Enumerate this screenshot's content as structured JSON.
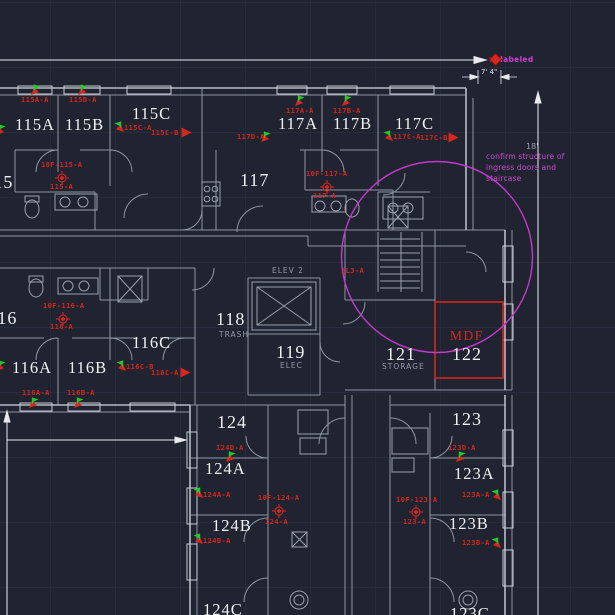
{
  "annotations": {
    "unlabeled": "unlabeled",
    "note": "confirm structure of\ningress doors and\nstaircase",
    "dim_width": "7' 4\"",
    "dim_height": "18'",
    "mdf": "MDF"
  },
  "rooms": [
    {
      "id": "115",
      "label": "115",
      "x": -16,
      "y": 173
    },
    {
      "id": "115A",
      "label": "115A",
      "x": 15,
      "y": 117
    },
    {
      "id": "115B",
      "label": "115B",
      "x": 65,
      "y": 117
    },
    {
      "id": "115C",
      "label": "115C",
      "x": 132,
      "y": 106
    },
    {
      "id": "117",
      "label": "117",
      "x": 240,
      "y": 171
    },
    {
      "id": "117A",
      "label": "117A",
      "x": 278,
      "y": 116
    },
    {
      "id": "117B",
      "label": "117B",
      "x": 333,
      "y": 116
    },
    {
      "id": "117C",
      "label": "117C",
      "x": 395,
      "y": 116
    },
    {
      "id": "116",
      "label": "116",
      "x": -12,
      "y": 309
    },
    {
      "id": "116A",
      "label": "116A",
      "x": 12,
      "y": 360
    },
    {
      "id": "116B",
      "label": "116B",
      "x": 68,
      "y": 360
    },
    {
      "id": "116C",
      "label": "116C",
      "x": 132,
      "y": 335
    },
    {
      "id": "118",
      "label": "118",
      "x": 216,
      "y": 310
    },
    {
      "id": "119",
      "label": "119",
      "x": 276,
      "y": 343
    },
    {
      "id": "121",
      "label": "121",
      "x": 386,
      "y": 345
    },
    {
      "id": "122",
      "label": "122",
      "x": 452,
      "y": 345
    },
    {
      "id": "123",
      "label": "123",
      "x": 452,
      "y": 410
    },
    {
      "id": "123A",
      "label": "123A",
      "x": 454,
      "y": 466
    },
    {
      "id": "123B",
      "label": "123B",
      "x": 449,
      "y": 516
    },
    {
      "id": "124",
      "label": "124",
      "x": 217,
      "y": 413
    },
    {
      "id": "124A",
      "label": "124A",
      "x": 205,
      "y": 461
    },
    {
      "id": "124B",
      "label": "124B",
      "x": 212,
      "y": 518
    },
    {
      "id": "124C",
      "label": "124C",
      "x": 203,
      "y": 602
    },
    {
      "id": "123C",
      "label": "123C",
      "x": 450,
      "y": 606
    }
  ],
  "areas": [
    {
      "id": "elev-2",
      "label": "ELEV 2",
      "x": 272,
      "y": 267
    },
    {
      "id": "trash",
      "label": "TRASH",
      "x": 219,
      "y": 331
    },
    {
      "id": "elec",
      "label": "ELEC",
      "x": 280,
      "y": 362
    },
    {
      "id": "storage",
      "label": "STORAGE",
      "x": 382,
      "y": 363
    }
  ],
  "devices": [
    {
      "id": "115A-A",
      "text": "115A-A",
      "x": 21,
      "y": 97,
      "icon": "horn-strobe",
      "ix": 31,
      "iy": 84
    },
    {
      "id": "115B-A",
      "text": "115B-A",
      "x": 69,
      "y": 97,
      "icon": "horn-strobe",
      "ix": 78,
      "iy": 84
    },
    {
      "id": "115C-A",
      "text": "115C-A",
      "x": 124,
      "y": 125,
      "icon": "horn-strobe",
      "ix": 113,
      "iy": 121,
      "flip": true
    },
    {
      "id": "115C-B",
      "text": "115C-B",
      "x": 151,
      "y": 130,
      "icon": "arrow-right",
      "ix": 181,
      "iy": 127
    },
    {
      "id": "10F-115-A",
      "text": "10F-115-A",
      "x": 41,
      "y": 162,
      "icon": "smoke-detector",
      "ix": 55,
      "iy": 171
    },
    {
      "id": "115-A",
      "text": "115-A",
      "x": 50,
      "y": 184
    },
    {
      "id": "117D-A",
      "text": "117D-A",
      "x": 237,
      "y": 134,
      "icon": "horn-strobe",
      "ix": 261,
      "iy": 131
    },
    {
      "id": "117A-A",
      "text": "117A-A",
      "x": 286,
      "y": 108,
      "icon": "horn-strobe",
      "ix": 295,
      "iy": 95
    },
    {
      "id": "117B-A",
      "text": "117B-A",
      "x": 333,
      "y": 108,
      "icon": "horn-strobe",
      "ix": 342,
      "iy": 95
    },
    {
      "id": "117C-A",
      "text": "117C-A",
      "x": 393,
      "y": 134,
      "icon": "horn-strobe",
      "ix": 382,
      "iy": 130,
      "flip": true
    },
    {
      "id": "117C-B",
      "text": "117C-B",
      "x": 420,
      "y": 135,
      "icon": "arrow-right",
      "ix": 448,
      "iy": 132
    },
    {
      "id": "10F-117-A",
      "text": "10F-117-A",
      "x": 306,
      "y": 171,
      "icon": "smoke-detector",
      "ix": 320,
      "iy": 180
    },
    {
      "id": "117-A",
      "text": "117-A",
      "x": 313,
      "y": 193
    },
    {
      "id": "1L3-A",
      "text": "1L3-A",
      "x": 341,
      "y": 268
    },
    {
      "id": "10F-116-A",
      "text": "10F-116-A",
      "x": 43,
      "y": 303,
      "icon": "smoke-detector",
      "ix": 56,
      "iy": 312
    },
    {
      "id": "116-A",
      "text": "116-A",
      "x": 50,
      "y": 324
    },
    {
      "id": "116C-B",
      "text": "116C-B",
      "x": 126,
      "y": 364,
      "icon": "horn-strobe",
      "ix": 115,
      "iy": 360,
      "flip": true
    },
    {
      "id": "116C-A",
      "text": "116C-A",
      "x": 151,
      "y": 370,
      "icon": "arrow-right",
      "ix": 180,
      "iy": 367
    },
    {
      "id": "116A-A",
      "text": "116A-A",
      "x": 22,
      "y": 390,
      "icon": "horn-strobe",
      "ix": 29,
      "iy": 397
    },
    {
      "id": "116B-A",
      "text": "116B-A",
      "x": 67,
      "y": 390,
      "icon": "horn-strobe",
      "ix": 74,
      "iy": 397
    },
    {
      "id": "124D-A",
      "text": "124D-A",
      "x": 216,
      "y": 445,
      "icon": "horn-strobe",
      "ix": 226,
      "iy": 451
    },
    {
      "id": "124A-A",
      "text": "124A-A",
      "x": 203,
      "y": 492,
      "icon": "horn-strobe",
      "ix": 192,
      "iy": 487,
      "flip": true
    },
    {
      "id": "10F-124-A",
      "text": "10F-124-A",
      "x": 258,
      "y": 495,
      "icon": "smoke-detector",
      "ix": 272,
      "iy": 504
    },
    {
      "id": "124-A",
      "text": "124-A",
      "x": 265,
      "y": 519
    },
    {
      "id": "124B-A",
      "text": "124B-A",
      "x": 203,
      "y": 538,
      "icon": "horn-strobe",
      "ix": 192,
      "iy": 533,
      "flip": true
    },
    {
      "id": "123D-A",
      "text": "123D-A",
      "x": 448,
      "y": 445,
      "icon": "horn-strobe",
      "ix": 456,
      "iy": 451
    },
    {
      "id": "123A-A",
      "text": "123A-A",
      "x": 462,
      "y": 492,
      "icon": "horn-strobe",
      "ix": 490,
      "iy": 489,
      "flip": true
    },
    {
      "id": "10F-123-A",
      "text": "10F-123-A",
      "x": 396,
      "y": 497,
      "icon": "smoke-detector",
      "ix": 409,
      "iy": 505
    },
    {
      "id": "123-A",
      "text": "123-A",
      "x": 403,
      "y": 519
    },
    {
      "id": "123B-A",
      "text": "123B-A",
      "x": 462,
      "y": 540,
      "icon": "horn-strobe",
      "ix": 490,
      "iy": 537,
      "flip": true
    },
    {
      "id": "edge-115",
      "text": "",
      "icon": "horn-strobe",
      "ix": -4,
      "iy": 124
    },
    {
      "id": "edge-116",
      "text": "",
      "icon": "horn-strobe",
      "ix": -4,
      "iy": 360
    }
  ],
  "colors": {
    "background": "#1f2430",
    "grid": "#262c3b",
    "walls": "#8d95a0",
    "walls_bright": "#b6bcc5",
    "windows": "#c7ccd3",
    "dimension": "#e8eaee",
    "alarm_red": "#d8261c",
    "alarm_green": "#25c825",
    "markup_magenta": "#cf3fd4",
    "room_text": "#eef0f3",
    "area_text": "#929aa5"
  }
}
